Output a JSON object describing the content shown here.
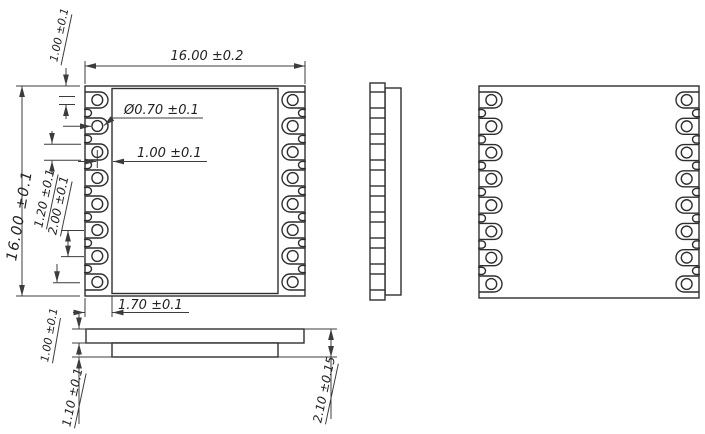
{
  "title": "Module package mechanical drawing",
  "dimensions": {
    "width_top": "16.00 ±0.2",
    "height_left": "16.00 ±0.1",
    "pad_edge_offset": "1.00 ±0.1",
    "hole_diameter": "Ø0.70 ±0.1",
    "hole_to_body": "1.00 ±0.1",
    "pad_width": "1.20 ±0.1",
    "pad_pitch": "2.00 ±0.1",
    "body_inset": "1.70 ±0.1",
    "pcb_thickness": "1.00 ±0.1",
    "underside_height": "1.10 ±0.1",
    "total_thickness": "2.10 ±0.15"
  },
  "geometry": {
    "canvas": {
      "w": 705,
      "h": 434
    },
    "pads_per_side": 8,
    "top_view": {
      "x": 85,
      "y": 86,
      "w": 220,
      "h": 210,
      "inner_inset_x": 27,
      "inner_inset_y": 2.5,
      "pads": {
        "count": 8,
        "margin": 14,
        "len": 23,
        "half_h": 8,
        "hole_r": 5.4,
        "hole_inset": 12.3
      },
      "notch": {
        "half_h": 3.6,
        "depth": 6.5
      }
    },
    "side_view": {
      "strip": {
        "x": 370,
        "y": 83,
        "w": 15,
        "h": 217
      },
      "body": {
        "x": 385,
        "y": 88,
        "w": 16,
        "h": 207
      }
    },
    "back_view": {
      "x": 479,
      "y": 86,
      "w": 220,
      "h": 212,
      "pads": {
        "count": 8,
        "margin": 14,
        "len": 23,
        "half_h": 8,
        "hole_r": 5.4,
        "hole_inset": 12.3
      },
      "notch": {
        "half_h": 3.6,
        "depth": 6.5
      }
    },
    "bottom_view": {
      "pcb": {
        "x": 86,
        "y": 329,
        "w": 218,
        "h": 14
      },
      "block": {
        "x": 112,
        "y": 343,
        "w": 166,
        "h": 14
      }
    }
  }
}
